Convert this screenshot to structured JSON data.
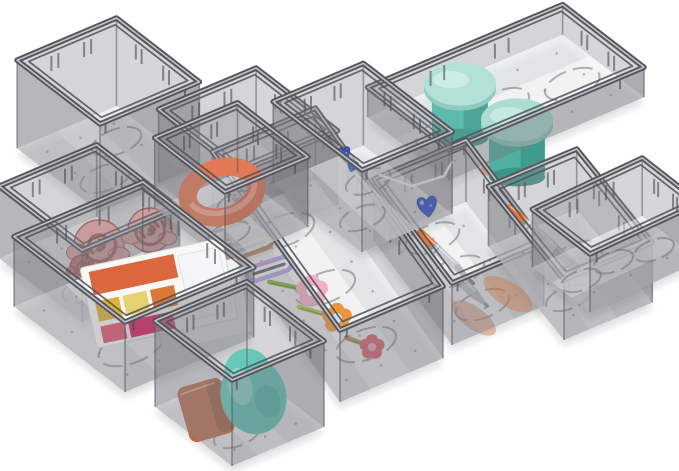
{
  "subject": "drawer-organizer-bins-product-photo",
  "image": {
    "width": 679,
    "height": 471,
    "background": "#ffffff"
  },
  "scene": {
    "axes": {
      "ex": [
        0.92,
        -0.39
      ],
      "ey": [
        -0.74,
        -0.57
      ]
    },
    "plastic": {
      "rim": "#55575d",
      "rimHi": "#c0c2c6",
      "innerRim": "rgba(80,82,88,0.85)",
      "wallBackL": "rgba(125,127,133,0.34)",
      "wallBackR": "rgba(112,114,120,0.30)",
      "wallFrontR": "rgba(118,120,126,0.42)",
      "wallFrontL": "rgba(136,138,144,0.38)",
      "floor": "rgba(228,229,232,0.55)",
      "sheen": "rgba(255,255,255,0.55)",
      "edge": "rgba(86,88,94,0.55)",
      "ring": "rgba(98,100,106,0.5)",
      "dot": "rgba(115,117,123,0.5)",
      "rib": "rgba(75,77,83,0.65)",
      "shadow": "rgba(45,47,53,0.15)"
    },
    "bins": [
      {
        "id": "square-back-left",
        "fc": [
          100,
          212
        ],
        "w": 108,
        "d": 112,
        "h": 88,
        "items": []
      },
      {
        "id": "square-back-mid",
        "fc": [
          240,
          246
        ],
        "w": 106,
        "d": 110,
        "h": 74,
        "items": []
      },
      {
        "id": "long-jars",
        "fc": [
          449,
          180
        ],
        "w": 212,
        "d": 110,
        "h": 30,
        "items": [
          {
            "type": "blob",
            "x": 505,
            "y": 163,
            "rx": 26,
            "ry": 10,
            "rot": -20,
            "color": "#d96a35",
            "op": 0.5
          },
          {
            "type": "jar",
            "x": 460,
            "y": 84,
            "r": 36,
            "bodyH": 52,
            "lid": "#aee0d5",
            "body": "#55b7a8",
            "base": "#3f9a8c"
          },
          {
            "type": "jar",
            "x": 517,
            "y": 120,
            "r": 36,
            "bodyH": 55,
            "lid": "#a7dcd2",
            "body": "#4fb0a2",
            "base": "#3a9487"
          }
        ]
      },
      {
        "id": "long-pens-middle",
        "fc": [
          452,
          345
        ],
        "ey": [
          -0.6,
          -0.8
        ],
        "w": 100,
        "d": 130,
        "h": 62,
        "items": [
          {
            "type": "pen",
            "x": 446,
            "y": 258,
            "rot": 43,
            "len": 78,
            "body": "#c6c9ce",
            "band": "#e8702f",
            "op": 1
          },
          {
            "type": "pen",
            "x": 468,
            "y": 288,
            "rot": 43,
            "len": 56,
            "body": "#b9bdc3",
            "band": "#d3d6da",
            "op": 0.8
          },
          {
            "type": "blob",
            "x": 474,
            "y": 318,
            "rx": 26,
            "ry": 11,
            "rot": 36,
            "color": "#c97a4f",
            "op": 0.45
          }
        ]
      },
      {
        "id": "long-flower-clips",
        "fc": [
          340,
          402
        ],
        "ey": [
          -0.58,
          -0.81
        ],
        "w": 112,
        "d": 220,
        "h": 72,
        "items": [
          {
            "type": "clip",
            "x": 232,
            "y": 226,
            "rot": -20,
            "len": 48,
            "color": "#dfb6b0",
            "op": 1
          },
          {
            "type": "clip",
            "x": 249,
            "y": 247,
            "rot": -20,
            "len": 48,
            "color": "#c08a5f",
            "op": 1
          },
          {
            "type": "clip",
            "x": 269,
            "y": 269,
            "rot": -18,
            "len": 46,
            "color": "#b59cd6",
            "op": 1
          },
          {
            "type": "flower",
            "x": 312,
            "y": 291,
            "r": 14,
            "petal": "#f3aac6",
            "center": "#ffffff",
            "stemRot": 192,
            "stemLen": 46,
            "stem": "#7fae3a",
            "op": 1
          },
          {
            "type": "flower",
            "x": 337,
            "y": 318,
            "r": 13,
            "petal": "#ee8f35",
            "center": "#cfe3ee",
            "stemRot": 196,
            "stemLen": 42,
            "stem": "#aebf3f",
            "op": 1
          },
          {
            "type": "flower",
            "x": 372,
            "y": 347,
            "r": 11,
            "petal": "#d94f5a",
            "center": "#e8a0a6",
            "stemRot": 200,
            "stemLen": 30,
            "stem": "#b08a5a",
            "op": 0.85
          }
        ]
      },
      {
        "id": "rect-hearts",
        "fc": [
          362,
          252
        ],
        "w": 98,
        "d": 120,
        "h": 82,
        "items": [
          {
            "type": "cord",
            "pts": [
              [
                380,
                175
              ],
              [
                412,
                186
              ],
              [
                444,
                176
              ],
              [
                452,
                162
              ]
            ],
            "color": "#f3f3f3"
          },
          {
            "type": "heart",
            "x": 344,
            "y": 152,
            "s": 9,
            "rot": -12,
            "color": "#2e4ecf"
          },
          {
            "type": "heart",
            "x": 353,
            "y": 165,
            "s": 7.5,
            "rot": 18,
            "color": "#3558d6"
          },
          {
            "type": "heart",
            "x": 427,
            "y": 204,
            "s": 14,
            "rot": -8,
            "color": "#2e4ecf"
          }
        ]
      },
      {
        "id": "square-roses",
        "fc": [
          82,
          322
        ],
        "w": 106,
        "d": 112,
        "h": 72,
        "items": [
          {
            "type": "rose",
            "x": 99,
            "y": 245,
            "r": 25,
            "fill": "#e8a29b",
            "dark": "#a84a44"
          },
          {
            "type": "rose",
            "x": 150,
            "y": 230,
            "r": 22,
            "fill": "#eaaaa2",
            "dark": "#a84a44"
          },
          {
            "type": "rose",
            "x": 82,
            "y": 267,
            "r": 12,
            "fill": "#c05a50",
            "dark": "#8c3a34"
          }
        ]
      },
      {
        "id": "square-coral",
        "fc": [
          225,
          262
        ],
        "w": 90,
        "d": 95,
        "h": 70,
        "items": [
          {
            "type": "coil",
            "x": 222,
            "y": 192,
            "r": 35,
            "color": "#e2714b",
            "hi": "#f4a184"
          }
        ]
      },
      {
        "id": "long-pens-right",
        "fc": [
          564,
          340
        ],
        "ey": [
          -0.63,
          -0.78
        ],
        "w": 96,
        "d": 120,
        "h": 60,
        "items": [
          {
            "type": "pen",
            "x": 540,
            "y": 235,
            "rot": 40,
            "len": 88,
            "body": "#c9ccd1",
            "band": "#e8702f",
            "op": 1
          },
          {
            "type": "pen",
            "x": 565,
            "y": 258,
            "rot": 40,
            "len": 56,
            "body": "#aeb2b8",
            "band": "#d9dbdd",
            "op": 0.75
          },
          {
            "type": "blob",
            "x": 508,
            "y": 294,
            "rx": 28,
            "ry": 12,
            "rot": 33,
            "color": "#c97a4f",
            "op": 0.45
          }
        ]
      },
      {
        "id": "rect-right-front",
        "fc": [
          590,
          312
        ],
        "ex": [
          0.9,
          -0.42
        ],
        "ey": [
          -0.72,
          -0.56
        ],
        "w": 122,
        "d": 80,
        "h": 58,
        "items": []
      },
      {
        "id": "large-palette",
        "fc": [
          125,
          392
        ],
        "w": 140,
        "d": 150,
        "h": 70,
        "items": [
          {
            "type": "palette",
            "x": 80,
            "y": 268,
            "rot": -12,
            "w": 152,
            "h": 82,
            "case": "#faf8f5",
            "lid": "#f1f2f3",
            "pans": [
              "#d85f33",
              "#ddaf2e",
              "#e3cf6a",
              "#d9702f",
              "#e0506a",
              "#e41a5f"
            ]
          }
        ]
      },
      {
        "id": "small-sponge",
        "fc": [
          232,
          466
        ],
        "w": 100,
        "d": 104,
        "h": 86,
        "items": [
          {
            "type": "wedge",
            "x": 206,
            "y": 410,
            "s": 52,
            "rot": -16,
            "color": "#b26a4d"
          },
          {
            "type": "egg",
            "x": 252,
            "y": 390,
            "r": 42,
            "rot": -14,
            "color": "#5fc4b5"
          }
        ]
      }
    ]
  }
}
